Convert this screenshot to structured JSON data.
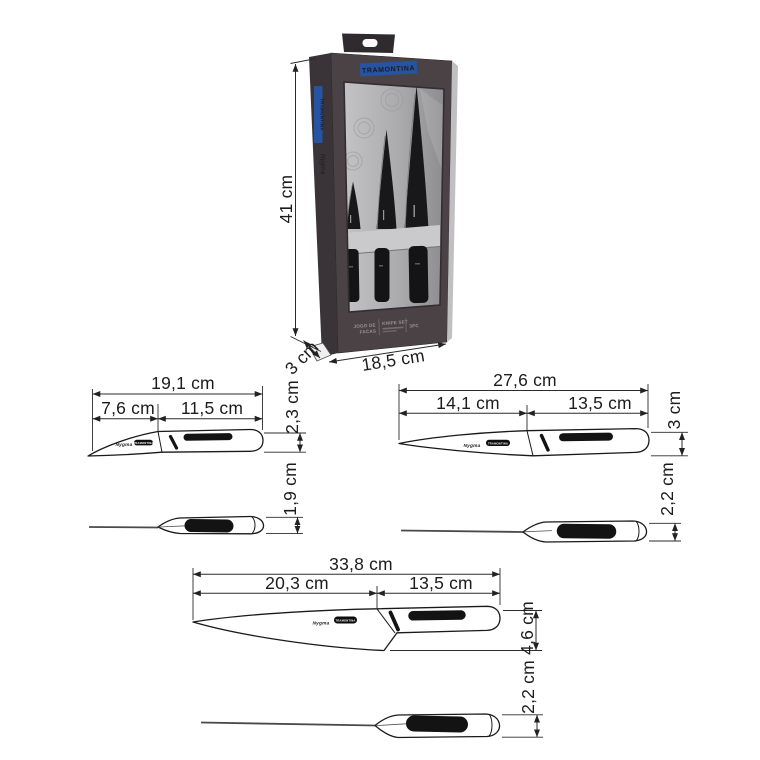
{
  "colors": {
    "badge_blue": "#2753a3",
    "box_body": "#4b4246",
    "box_spine": "#3a3438",
    "line_color": "#2b2b2b"
  },
  "box": {
    "badge_label": "TRAMONTINA",
    "spine_brand": "TRAMONTINA",
    "spine_line": "Nygma",
    "footer_left_line1": "JOGO DE",
    "footer_left_line2": "FACAS",
    "footer_center": "KNIFE SET",
    "footer_right": "3PC",
    "dim_height": "41 cm",
    "dim_width": "18,5 cm",
    "dim_depth": "3 cm"
  },
  "knives": [
    {
      "id": "paring-knife",
      "dim_total": "19,1 cm",
      "dim_blade": "7,6 cm",
      "dim_handle": "11,5 cm",
      "dim_height": "2,3 cm",
      "dim_thickness": "1,9 cm",
      "blade_mark": "Nygma",
      "blade_badge": "TRAMONTINA"
    },
    {
      "id": "utility-knife",
      "dim_total": "27,6 cm",
      "dim_blade": "14,1 cm",
      "dim_handle": "13,5 cm",
      "dim_height": "3 cm",
      "dim_thickness": "2,2 cm",
      "blade_mark": "Nygma",
      "blade_badge": "TRAMONTINA"
    },
    {
      "id": "chef-knife",
      "dim_total": "33,8 cm",
      "dim_blade": "20,3 cm",
      "dim_handle": "13,5 cm",
      "dim_height": "4,6 cm",
      "dim_thickness": "2,2 cm",
      "blade_mark": "Nygma",
      "blade_badge": "TRAMONTINA"
    }
  ]
}
